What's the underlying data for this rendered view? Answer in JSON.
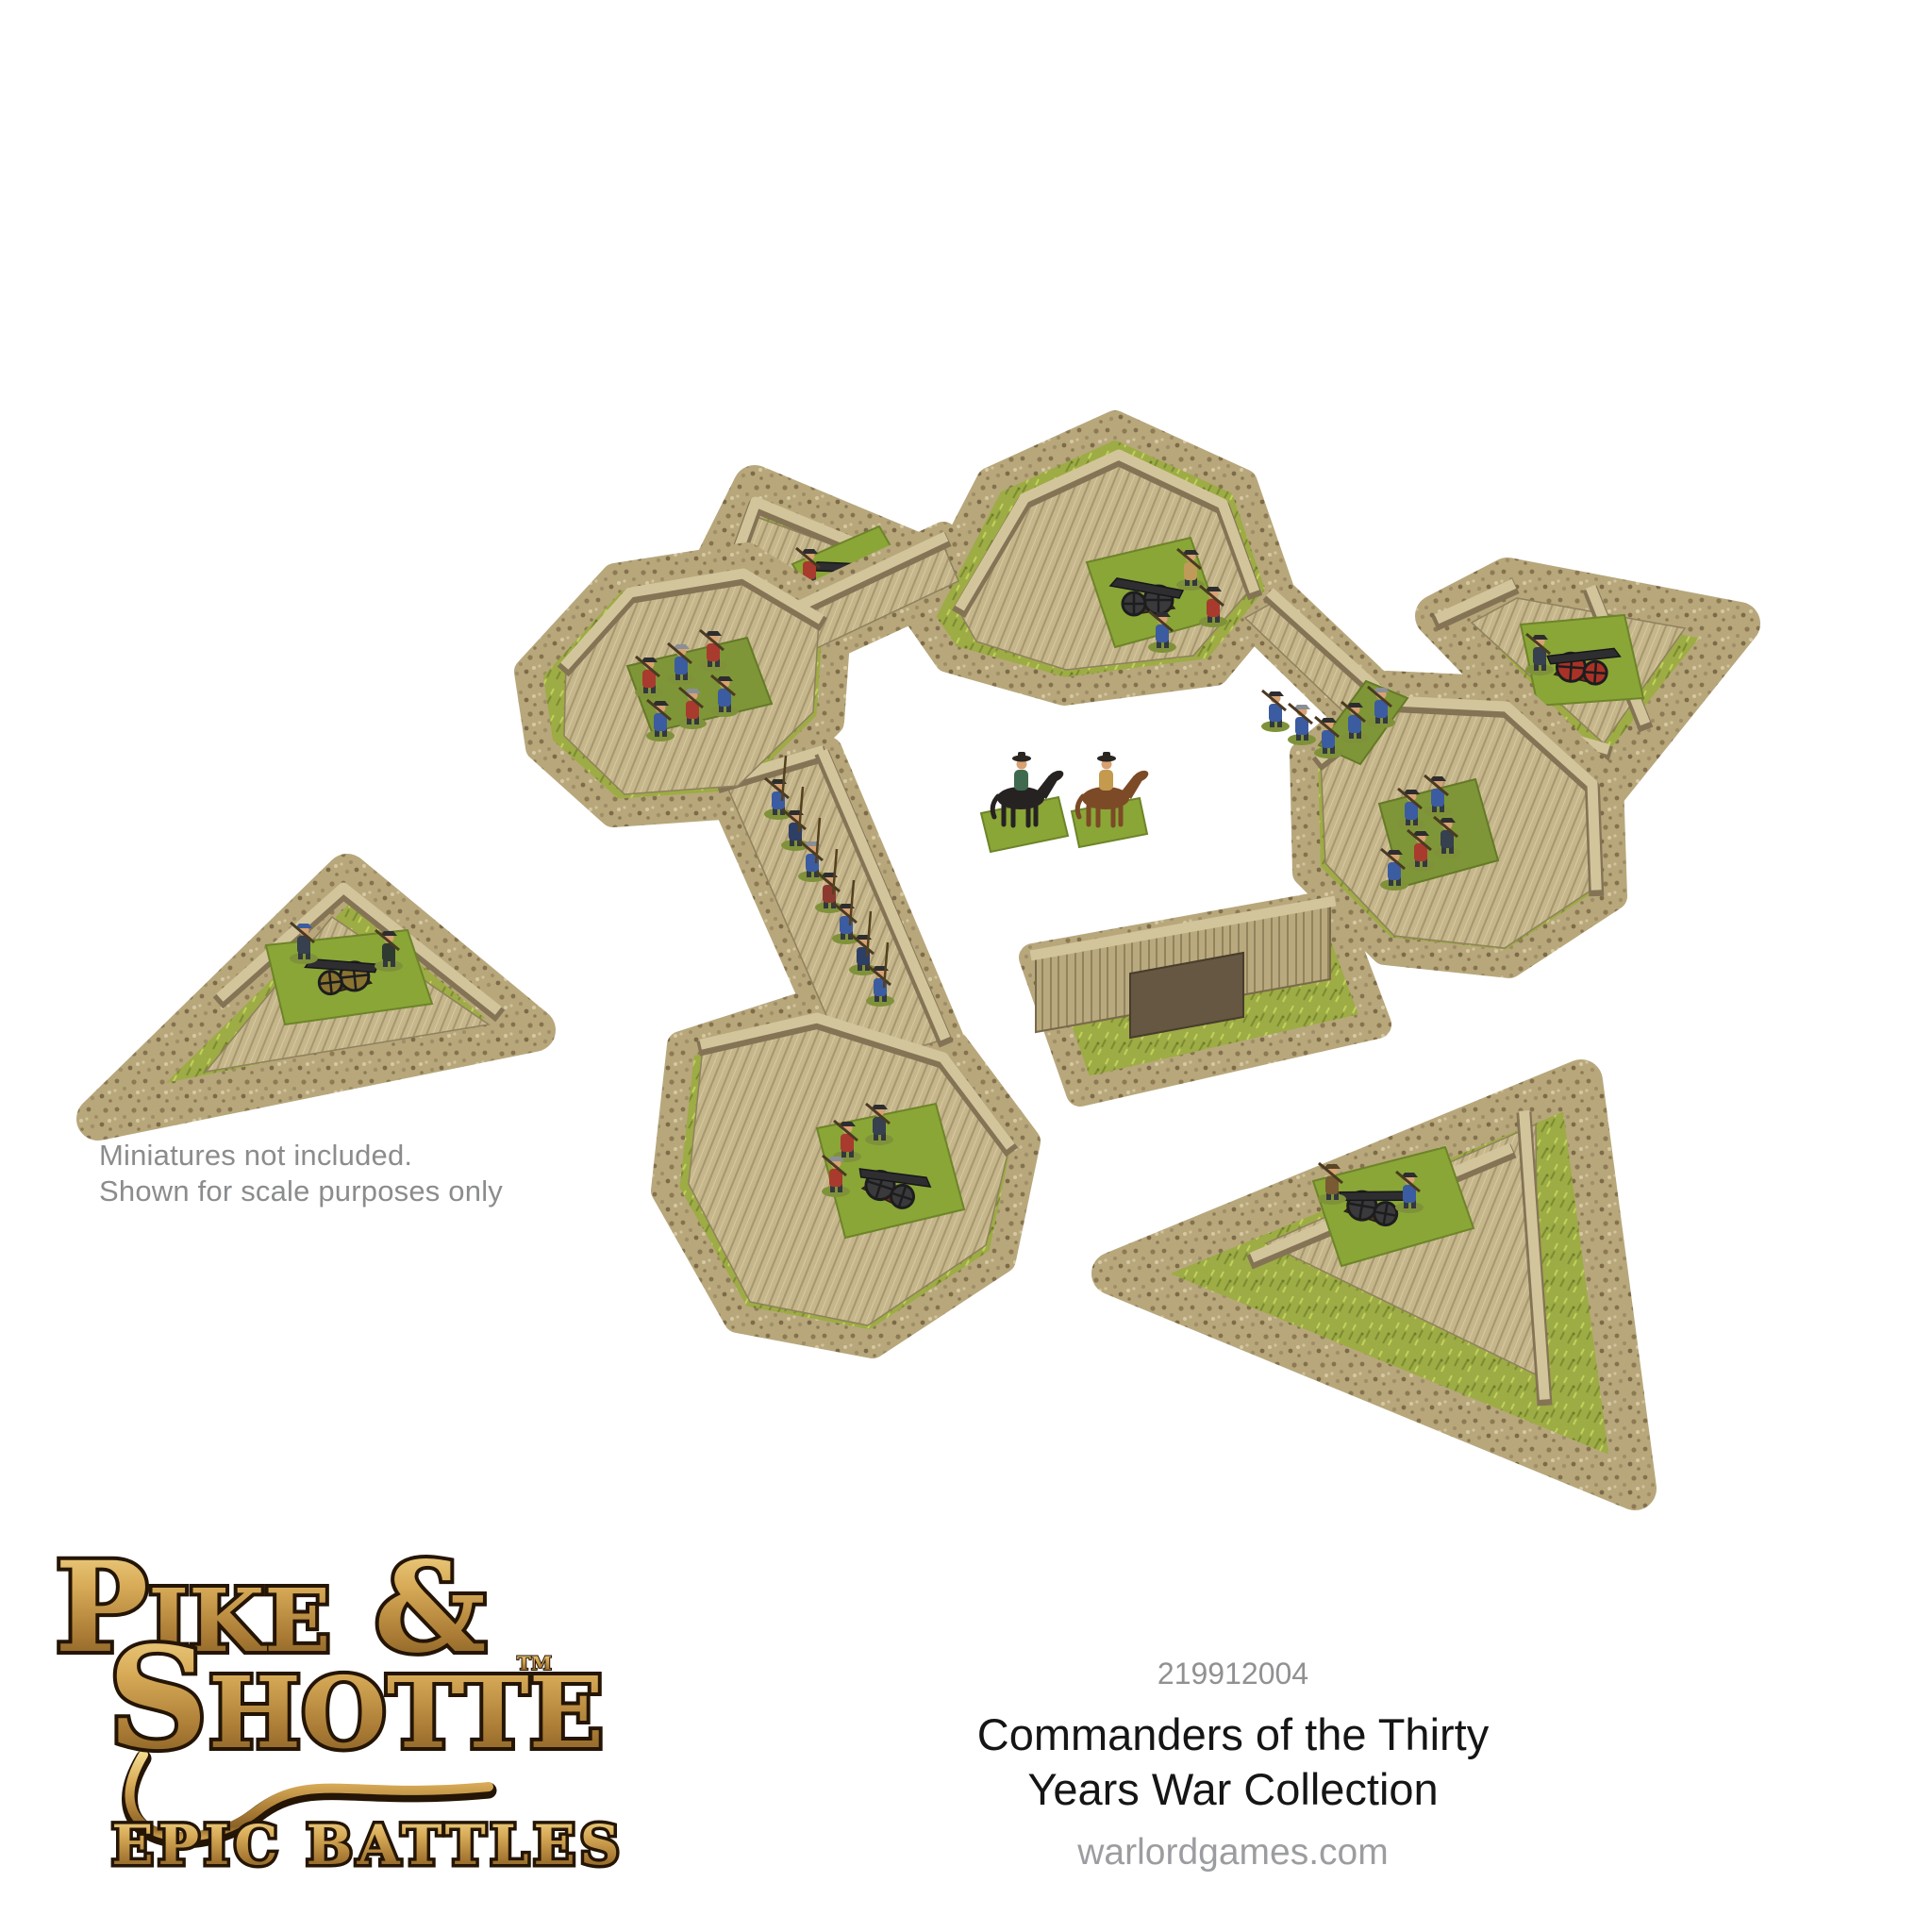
{
  "photo": {
    "alt": "Top-down angled photo of a tan wooden star fort terrain set: a square fort with four arrowhead bastions and plank curtain walls with a gate, surrounded by four detached triangular ravelins, dressed with grass and gravel. Small painted miniatures are placed inside: cannon crews, blue and red musketeers, a pike column and two mounted commanders in the courtyard."
  },
  "note": {
    "line1": "Miniatures not included.",
    "line2": "Shown for scale purposes only"
  },
  "product": {
    "code": "219912004",
    "title_line1": "Commanders of the Thirty",
    "title_line2": "Years War Collection",
    "website": "warlordgames.com"
  },
  "logo": {
    "line1": "Pike &",
    "line2": "Shotte",
    "trademark": "TM",
    "subtitle": "Epic Battles"
  },
  "palette": {
    "logo_gold": "#c79a4b",
    "logo_outline": "#241505",
    "note_gray": "#8a8c8e",
    "code_gray": "#8f9193",
    "title_black": "#151515",
    "website_gray": "#9b9da0",
    "grass_green": "#9dac44",
    "gravel_tan": "#b7a77b",
    "wood_light": "#d3c59b",
    "wood_mid": "#b9a97e",
    "wood_dark": "#847455",
    "uniform_blue": "#3b5ca0",
    "uniform_red": "#a93a2e",
    "cannon_black": "#2e2e31",
    "wheel_red": "#a83226",
    "horse_brown": "#7c4a26",
    "horse_black": "#272222"
  }
}
